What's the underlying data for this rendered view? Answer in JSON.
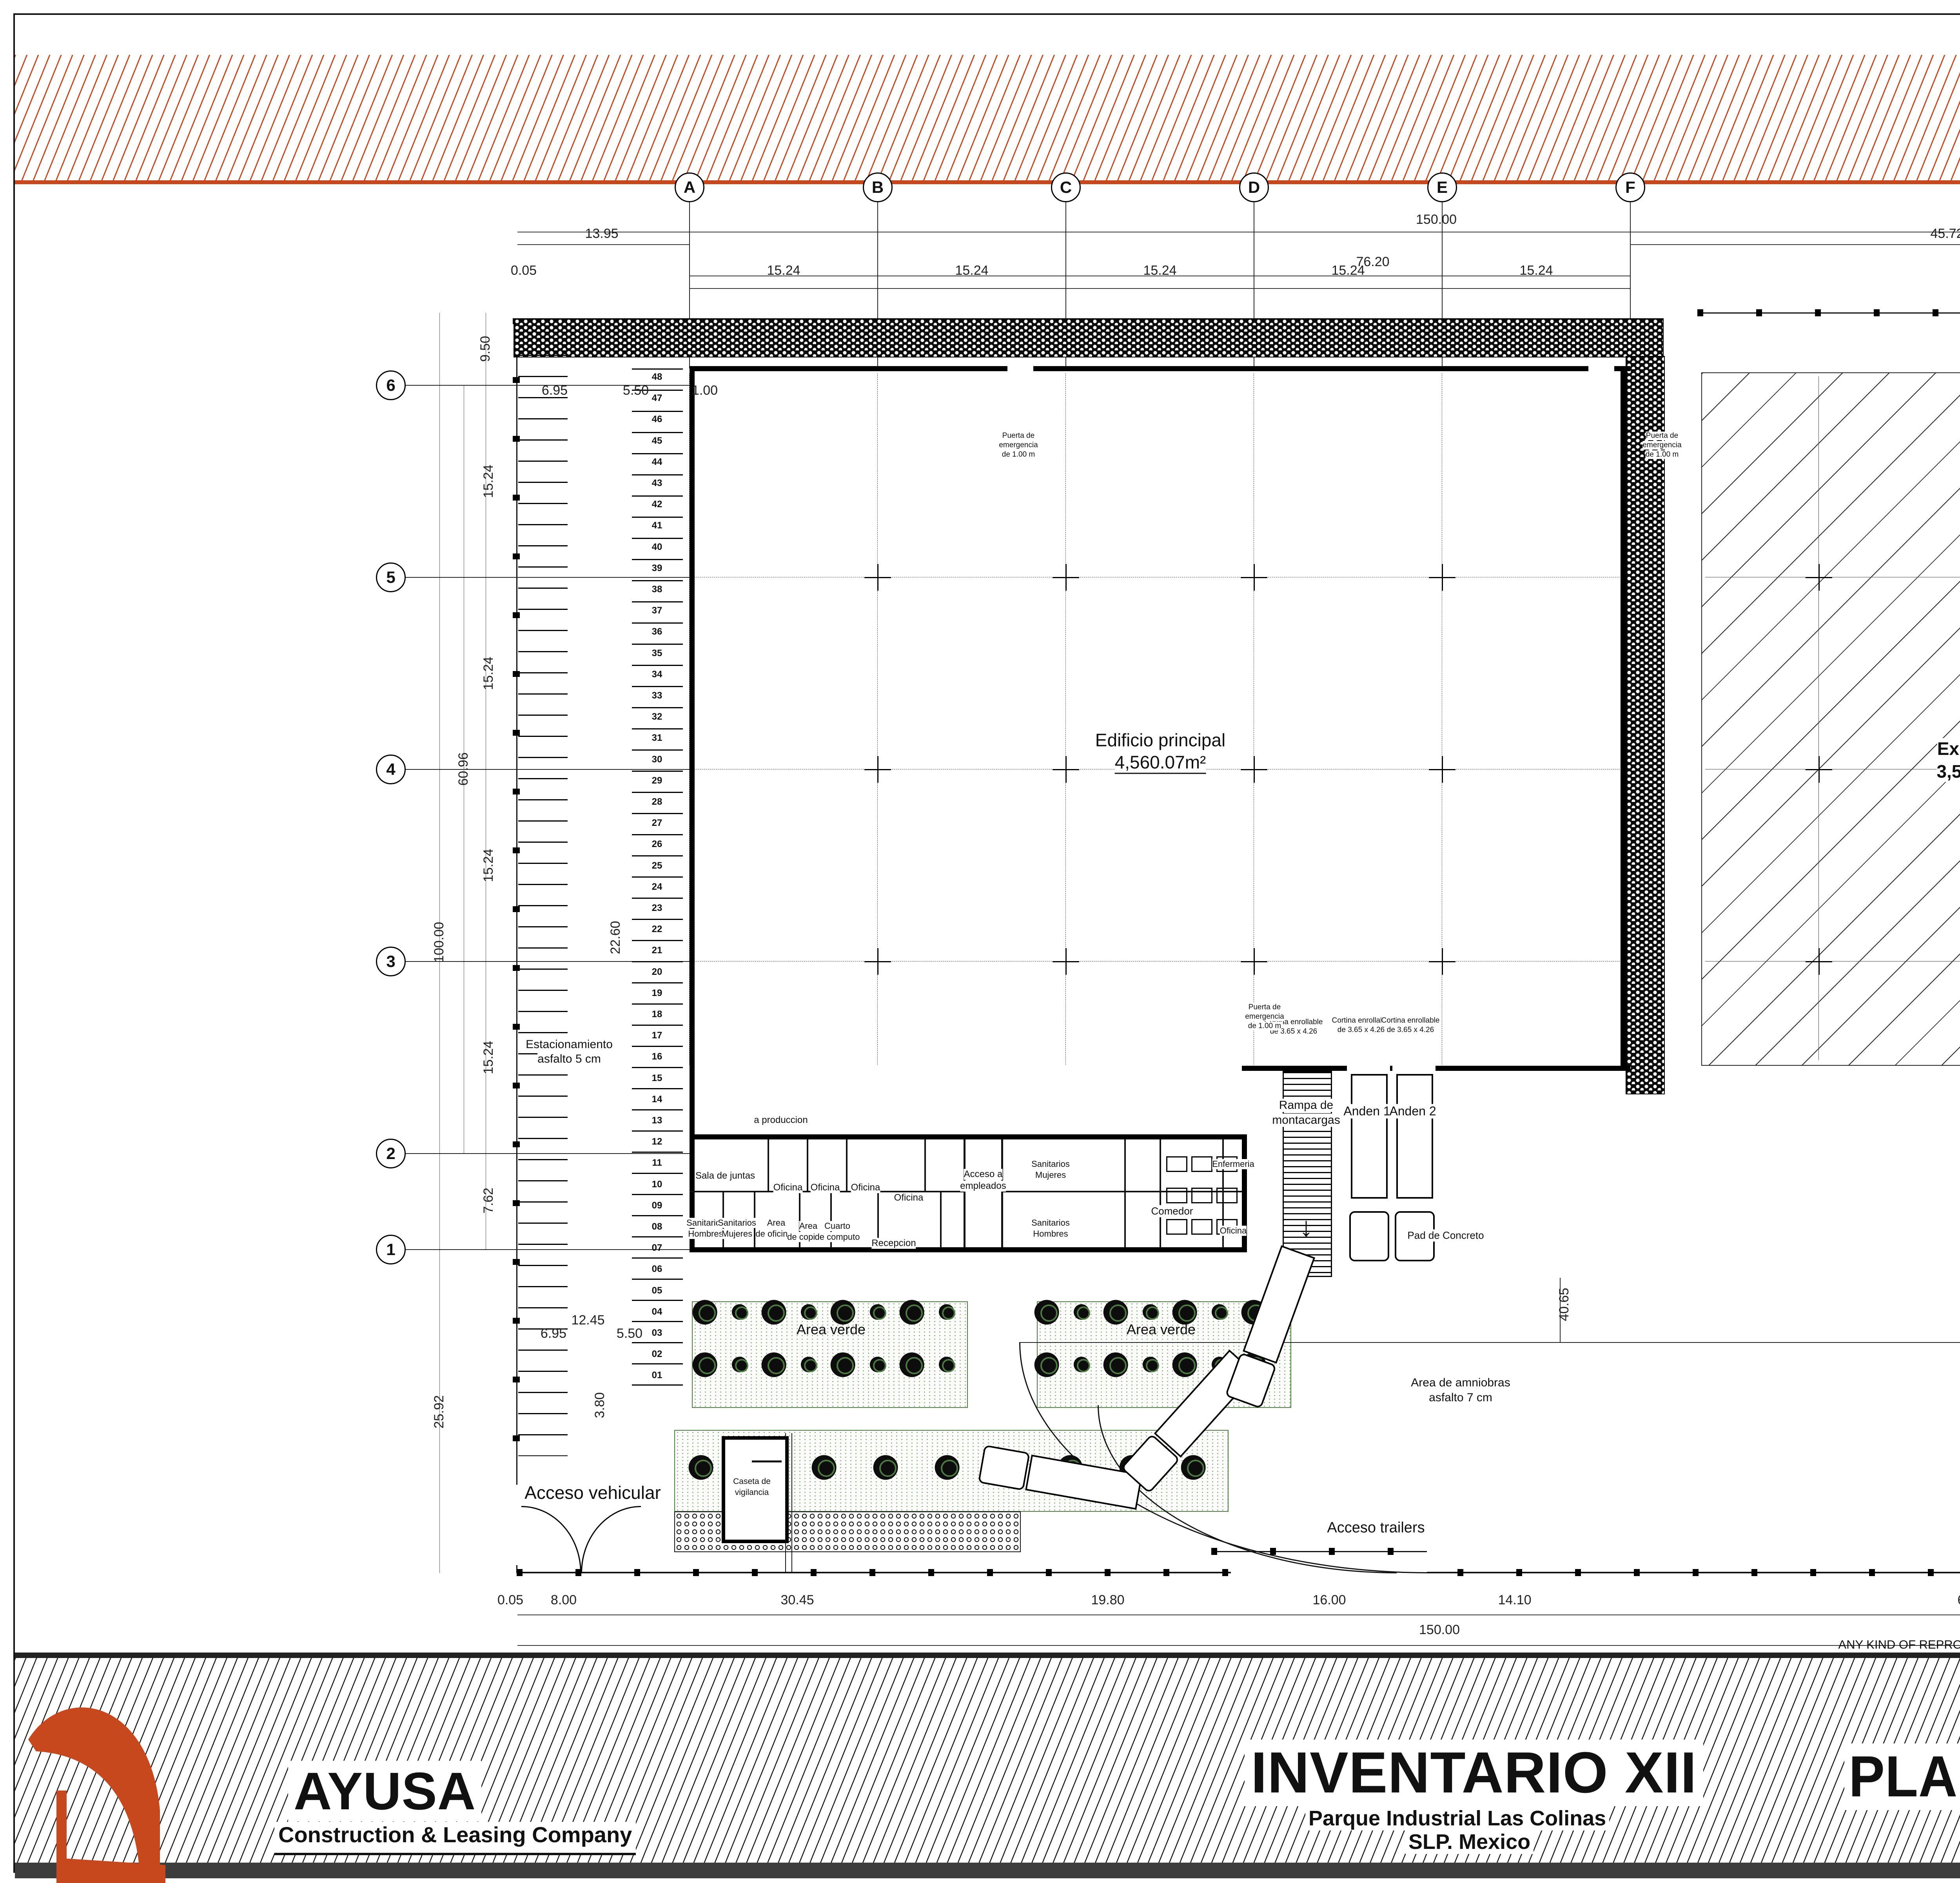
{
  "sheet": {
    "number": "A-02",
    "drawing_title": "PLANTA ARQUITECTONICA",
    "project_title": "INVENTARIO XII",
    "location_line1": "Parque Industrial Las Colinas",
    "location_line2": "SLP. Mexico",
    "scale_note": "SCALE 1:250 UNITS: METROS",
    "date_note": "22 MARZO  2024",
    "company": "AYUSA",
    "company_sub": "Construction  & Leasing Company",
    "confidential_title": "CONFIDENTIAL DOCUMENTS:",
    "confidential_text": "ANY KIND OF REPRODUCTION, COPY AND/OR DISTRIBUTION WITHOUT WRITTEN AUTHORIZATION FROM GRUPO AYUSA IS STRICTLY FORBIDDEN.",
    "accent": "#c8481e"
  },
  "grid": {
    "columns": [
      "A",
      "B",
      "C",
      "D",
      "E",
      "F"
    ],
    "rows": [
      "6",
      "5",
      "4",
      "3",
      "2",
      "1"
    ]
  },
  "buildings": {
    "main": {
      "name": "Edificio principal",
      "area": "4,560.07m²"
    },
    "expansion": {
      "name": "Expansion",
      "area": "3,554.70m²"
    }
  },
  "site_labels": {
    "parking_line1": "Estacionamiento",
    "parking_line2": "asfalto 5 cm",
    "vehicle_access": "Acceso vehicular",
    "guard_house_line1": "Caseta de",
    "guard_house_line2": "vigilancia",
    "trailer_access": "Acceso trailers",
    "green_area": "Area verde",
    "maneuver_line1": "Area de amniobras",
    "maneuver_line2": "asfalto 7 cm",
    "ramp_line1": "Rampa de",
    "ramp_line2": "montacargas",
    "dock1": "Anden 1",
    "dock2": "Anden 2",
    "concrete_pad": "Pad de Concreto",
    "rollup_line1": "Cortina enrollable",
    "rollup_line2": "de 3.65 x 4.26",
    "emergency_line1": "Puerta de",
    "emergency_line2": "emergencia",
    "emergency_line3": "de 1.00 m",
    "to_production": "a produccion"
  },
  "rooms": {
    "meeting": "Sala de juntas",
    "office": "Oficina",
    "wc_men_1": "Sanitarios Hombres",
    "wc_women_1": "Sanitarios Mujeres",
    "open_office": "Area de oficinas",
    "copy": "Area de copiado",
    "computer": "Cuarto de computo",
    "reception": "Recepcion",
    "employee_access_1": "Acceso a",
    "employee_access_2": "empleados",
    "wc_women_2": "Sanitarios Mujeres",
    "wc_men_2": "Sanitarios Hombres",
    "dining": "Comedor",
    "infirmary": "Enfermeria",
    "office2": "Oficina"
  },
  "parking": {
    "stall_first": 1,
    "stall_last": 48
  },
  "dimensions": {
    "overall": "150.00",
    "top_left": "13.95",
    "top_mid": "76.20",
    "top_r1": "45.72",
    "top_r2": "14.13",
    "offset": "0.05",
    "bay": "15.24",
    "drive": "6.95",
    "stall": "5.50",
    "walk": "1.00",
    "left_top": "9.50",
    "half_bay": "7.62",
    "left_total": "60.96",
    "side_total": "100.00",
    "left_low": "25.92",
    "office_depth": "22.60",
    "right_top": "5.00",
    "right_mid": "76.70",
    "right_low": "18.30",
    "dock_depth": "40.65",
    "block1": "12.45",
    "block_h": "3.80",
    "b1": "8.00",
    "b2": "30.45",
    "b3": "19.80",
    "b4": "16.00",
    "b5": "14.10",
    "b6": "61.60"
  }
}
